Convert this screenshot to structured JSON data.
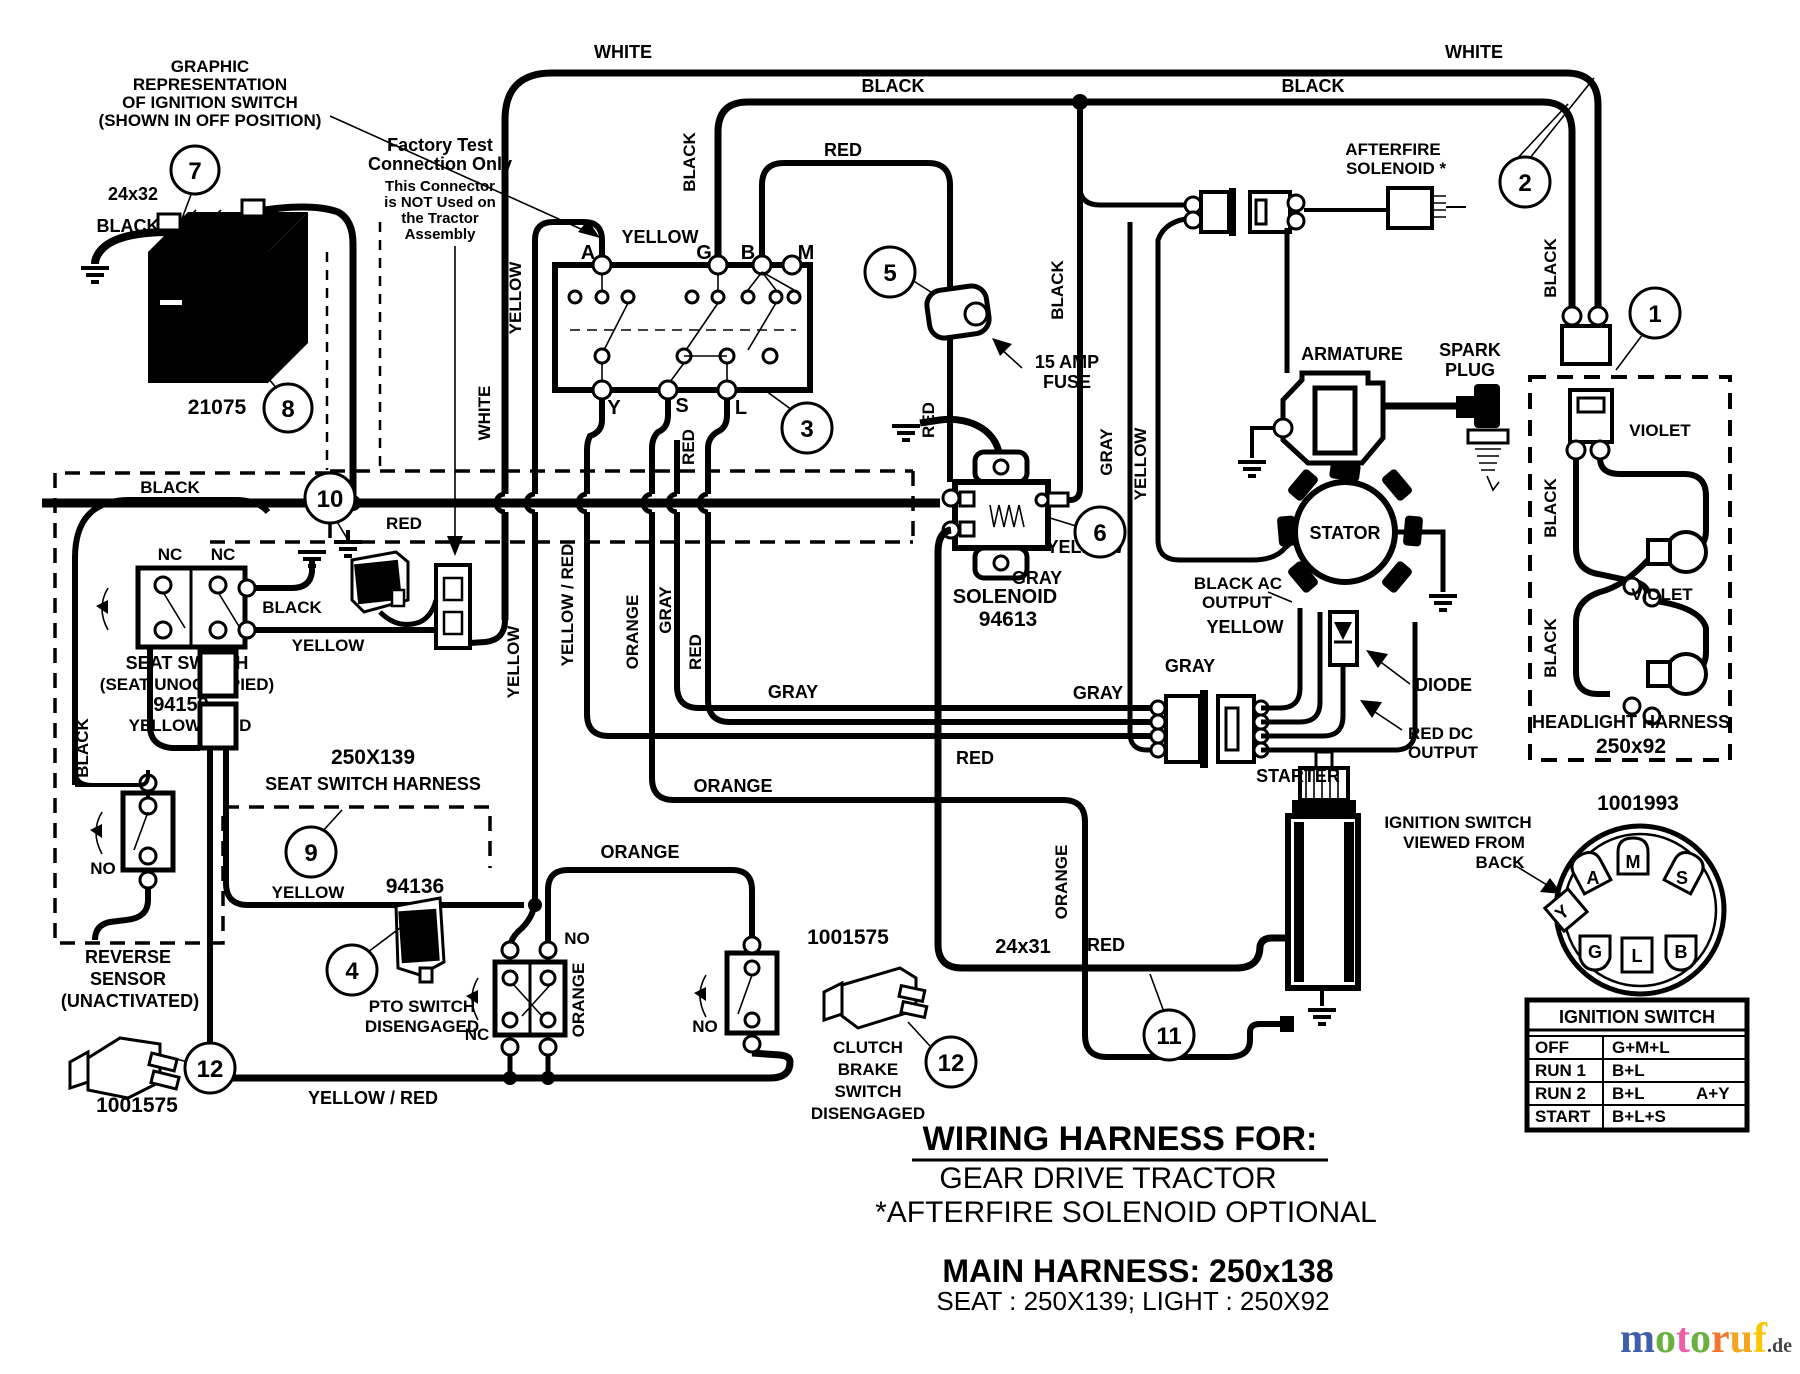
{
  "header_note": {
    "l1": "GRAPHIC",
    "l2": "REPRESENTATION",
    "l3": "OF IGNITION SWITCH",
    "l4": "(SHOWN IN OFF POSITION)"
  },
  "factory_note": {
    "l1": "Factory Test",
    "l2": "Connection Only",
    "l3": "This Connector",
    "l4": "is NOT Used on",
    "l5": "the Tractor",
    "l6": "Assembly"
  },
  "battery": {
    "name": "BATTERY",
    "part": "21075",
    "cable_size": "24x32",
    "cable_color": "BLACK"
  },
  "ignition_graphic": {
    "term_a": "A",
    "term_g": "G",
    "term_b": "B",
    "term_m": "M",
    "term_y": "Y",
    "term_s": "S",
    "term_l": "L"
  },
  "fuse": {
    "l1": "15 AMP",
    "l2": "FUSE"
  },
  "solenoid": {
    "name": "SOLENOID",
    "part": "94613"
  },
  "afterfire": {
    "l1": "AFTERFIRE",
    "l2": "SOLENOID *"
  },
  "engine": {
    "armature": "ARMATURE",
    "spark1": "SPARK",
    "spark2": "PLUG",
    "stator": "STATOR",
    "diode": "DIODE",
    "black_ac1": "BLACK AC",
    "black_ac2": "OUTPUT",
    "red_dc1": "RED DC",
    "red_dc2": "OUTPUT"
  },
  "headlight": {
    "name": "HEADLIGHT HARNESS",
    "part": "250x92",
    "violet1": "VIOLET",
    "violet2": "VIOLET",
    "black1": "BLACK",
    "black2": "BLACK"
  },
  "ign_back": {
    "part": "1001993",
    "note1": "IGNITION SWITCH",
    "note2": "VIEWED FROM",
    "note3": "BACK",
    "tm": "M",
    "ta": "A",
    "ts": "S",
    "ty": "Y",
    "tg": "G",
    "tl": "L",
    "tb": "B"
  },
  "seat": {
    "l1": "SEAT SWITCH",
    "l2": "(SEAT UNOCCUPIED)",
    "part": "94159",
    "l3": "YELLOW / RED",
    "nc1": "NC",
    "nc2": "NC",
    "harness_part": "250X139",
    "harness_name": "SEAT SWITCH HARNESS"
  },
  "reverse": {
    "l1": "REVERSE",
    "l2": "SENSOR",
    "l3": "(UNACTIVATED)",
    "part": "1001575",
    "no": "NO"
  },
  "pto": {
    "part": "94136",
    "l1": "PTO SWITCH",
    "l2": "DISENGAGED",
    "nc": "NC",
    "no": "NO"
  },
  "clutch": {
    "part": "1001575",
    "l1": "CLUTCH",
    "l2": "BRAKE",
    "l3": "SWITCH",
    "l4": "DISENGAGED",
    "no": "NO"
  },
  "starter": {
    "name": "STARTER",
    "cable_size": "24x31",
    "cable_color": "RED"
  },
  "labels": {
    "white_tl": "WHITE",
    "white_tr": "WHITE",
    "black_t1": "BLACK",
    "black_t2": "BLACK",
    "yellow_sw": "YELLOW",
    "red_top": "RED",
    "black_g": "BLACK",
    "black_v1": "BLACK",
    "black_right": "BLACK",
    "yellow_v1": "YELLOW",
    "white_v": "WHITE",
    "red_v1": "RED",
    "red_v2": "RED",
    "yellow_v2": "YELLOW",
    "yr_v": "YELLOW / RED",
    "orange_v1": "ORANGE",
    "gray_v1": "GRAY",
    "red_v3": "RED",
    "gray_v2": "GRAY",
    "yellow_v3": "YELLOW",
    "orange_v2": "ORANGE",
    "orange_v3": "ORANGE",
    "black_seat": "BLACK",
    "black_arc": "BLACK",
    "yellow_seat": "YELLOW",
    "red_c10": "RED",
    "yellow_c9": "YELLOW",
    "black_left": "BLACK",
    "orange_h1": "ORANGE",
    "orange_h2": "ORANGE",
    "gray_h1": "GRAY",
    "gray_h2": "GRAY",
    "gray_h3": "GRAY",
    "gray_h4": "GRAY",
    "red_h1": "RED",
    "yellow_h1": "YELLOW",
    "yellow_h2": "YELLOW",
    "yr_bottom": "YELLOW / RED"
  },
  "table": {
    "title": "IGNITION SWITCH",
    "r1": [
      "OFF",
      "G+M+L",
      ""
    ],
    "r2": [
      "RUN 1",
      "B+L",
      ""
    ],
    "r3": [
      "RUN 2",
      "B+L",
      "A+Y"
    ],
    "r4": [
      "START",
      "B+L+S",
      ""
    ]
  },
  "title_block": {
    "l1": "WIRING HARNESS FOR:",
    "l2": "GEAR DRIVE TRACTOR",
    "l3": "*AFTERFIRE SOLENOID OPTIONAL",
    "l4": "MAIN HARNESS: 250x138",
    "l5": "SEAT : 250X139;    LIGHT : 250X92"
  },
  "callouts": {
    "c1": "1",
    "c2": "2",
    "c3": "3",
    "c4": "4",
    "c5": "5",
    "c6": "6",
    "c7": "7",
    "c8": "8",
    "c9": "9",
    "c10": "10",
    "c11": "11",
    "c12a": "12",
    "c12b": "12"
  },
  "watermark": {
    "m": "m",
    "o1": "o",
    "t": "t",
    "o2": "o",
    "r": "r",
    "u": "u",
    "f": "f",
    "tld": ".de",
    "colors": {
      "m": "#3f5fae",
      "o": "#69b03f",
      "t": "#ef5da8",
      "r": "#f2762e",
      "u": "#f5a51d",
      "f": "#fdc500",
      "tld": "#444444"
    }
  }
}
